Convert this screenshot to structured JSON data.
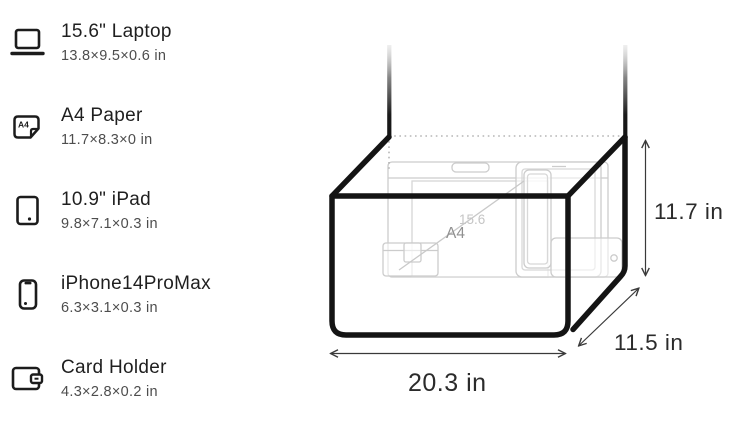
{
  "item_list": {
    "items": [
      {
        "name": "15.6\" Laptop",
        "dimensions": "13.8×9.5×0.6 in",
        "icon": "laptop-icon"
      },
      {
        "name": "A4 Paper",
        "dimensions": "11.7×8.3×0 in",
        "icon": "a4-paper-icon",
        "icon_label": "A4"
      },
      {
        "name": "10.9\" iPad",
        "dimensions": "9.8×7.1×0.3 in",
        "icon": "ipad-icon"
      },
      {
        "name": "iPhone14ProMax",
        "dimensions": "6.3×3.1×0.3 in",
        "icon": "iphone-icon"
      },
      {
        "name": "Card Holder",
        "dimensions": "4.3×2.8×0.2 in",
        "icon": "card-holder-icon"
      }
    ]
  },
  "diagram": {
    "height_label": "11.7 in",
    "depth_label": "11.5 in",
    "width_label": "20.3 in",
    "interior": {
      "a4_label": "A4",
      "laptop_label": "15.6"
    },
    "colors": {
      "bag_outline": "#141414",
      "dimension_text": "#2b2b2b",
      "faint_outline": "#cccccc"
    }
  }
}
